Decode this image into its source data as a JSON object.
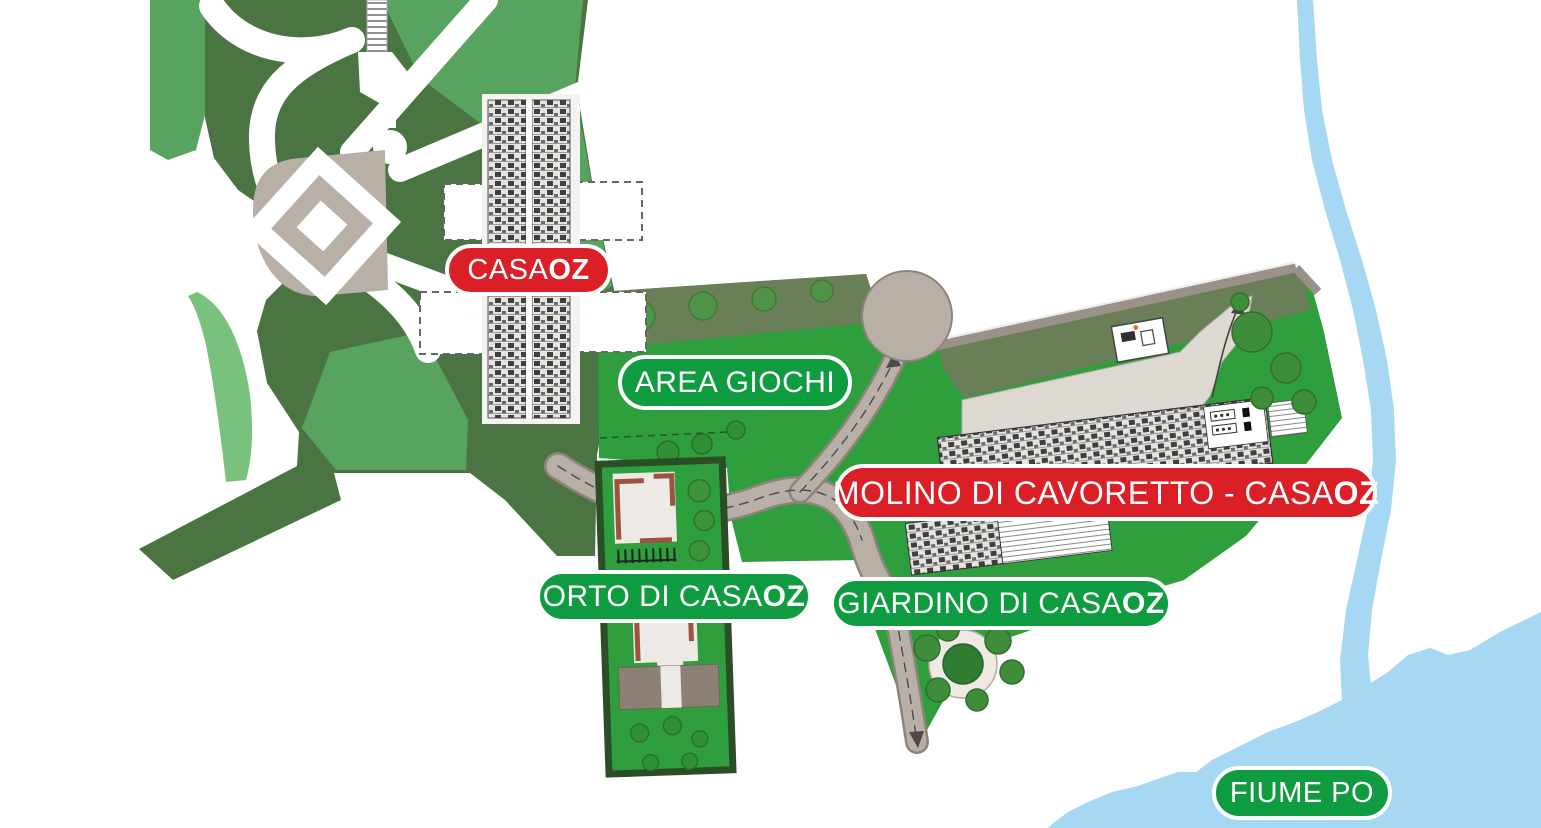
{
  "map": {
    "type": "illustrated-site-plan",
    "labels": {
      "casaoz": {
        "text": "CASA",
        "bold": "OZ",
        "style": "red"
      },
      "area_giochi": {
        "text": "AREA GIOCHI",
        "bold": "",
        "style": "green"
      },
      "molino": {
        "text": "MOLINO DI CAVORETTO - CASA",
        "bold": "OZ",
        "style": "red"
      },
      "orto": {
        "text": "ORTO DI CASA",
        "bold": "OZ",
        "style": "green"
      },
      "giardino": {
        "text": "GIARDINO DI CASA",
        "bold": "OZ",
        "style": "green"
      },
      "fiume_po": {
        "text": "FIUME PO",
        "bold": "",
        "style": "green"
      }
    },
    "regions": [
      "public-park",
      "casaoz-building",
      "area-giochi-zone",
      "molino-di-cavoretto-zone",
      "orto-di-casaoz-strip",
      "giardino-di-casaoz",
      "fiume-po-river"
    ]
  },
  "colors": {
    "label_red": "#da1f26",
    "label_green": "#0f9c40",
    "park_dark": "#4a7441",
    "park_medium": "#58a45e",
    "park_light": "#79c27e",
    "lawn": "#2f9e3c",
    "olive": "#6a7e58",
    "gravel": "#b8afa6",
    "gravel_dark": "#8d8379",
    "gravel_light": "#ddd8d2",
    "river": "#a6d7f3",
    "tree": "#4f9347",
    "tree_dark": "#2f8f35",
    "orto_border": "#2b4e26",
    "wall_brown": "#9c5340",
    "building_gray": "#8d8175"
  }
}
